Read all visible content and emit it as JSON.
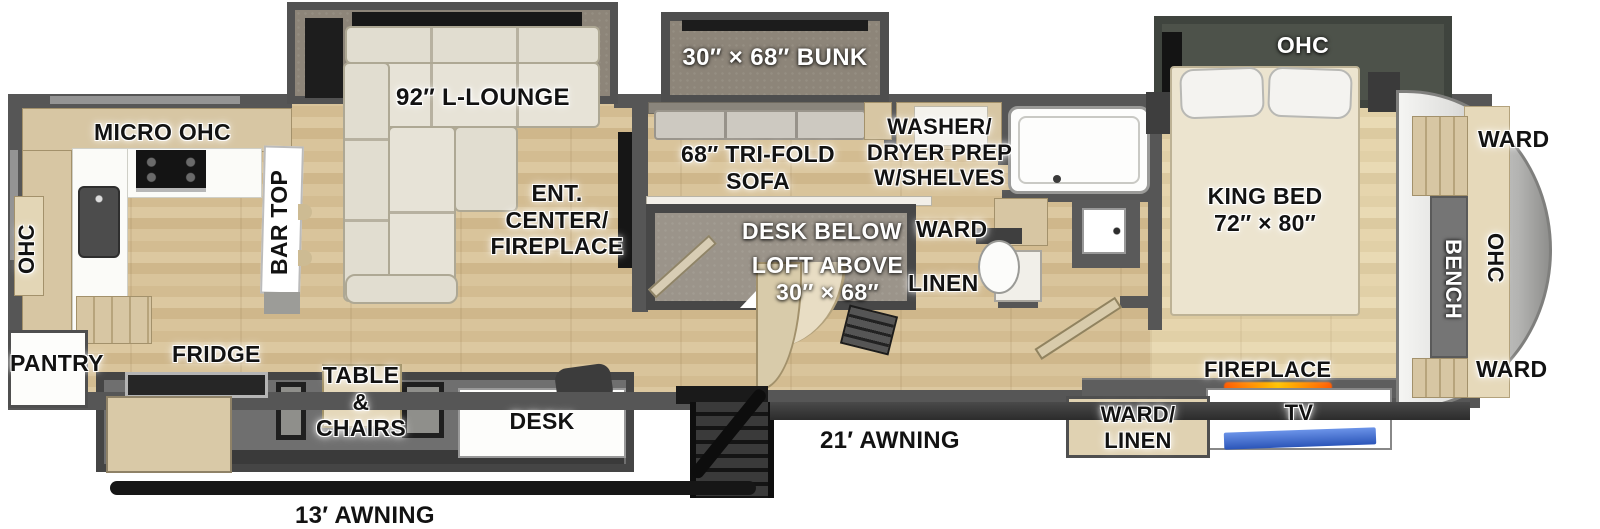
{
  "labels": {
    "kitchen": {
      "micro_ohc": "MICRO  OHC",
      "ohc_vertical": "OHC",
      "bar_top": "BAR TOP",
      "pantry": "PANTRY",
      "fridge": "FRIDGE"
    },
    "living": {
      "lounge": "92″ L-LOUNGE",
      "ent1": "ENT.",
      "ent2": "CENTER/",
      "ent3": "FIREPLACE"
    },
    "bunkroom": {
      "bunk": "30″ × 68″ BUNK",
      "trifold1": "68″ TRI-FOLD",
      "trifold2": "SOFA",
      "desk_below": "DESK BELOW",
      "loft1": "LOFT ABOVE",
      "loft2": "30″ × 68″"
    },
    "utility": {
      "washer1": "WASHER/",
      "washer2": "DRYER PREP",
      "washer3": "W/SHELVES",
      "ward": "WARD",
      "linen": "LINEN"
    },
    "dinette": {
      "table1": "TABLE",
      "table2": "&",
      "table3": "CHAIRS",
      "desk": "DESK"
    },
    "exterior": {
      "awning_13": "13′ AWNING",
      "awning_21": "21′ AWNING"
    },
    "bedroom": {
      "king1": "KING BED",
      "king2": "72″ × 80″",
      "ohc_slide": "OHC",
      "fireplace": "FIREPLACE",
      "tv": "TV",
      "wardlinen1": "WARD/",
      "wardlinen2": "LINEN"
    },
    "front_cap": {
      "ward_top": "WARD",
      "bench": "BENCH",
      "ohc": "OHC",
      "ward_bottom": "WARD"
    }
  },
  "colors": {
    "wall": "#565656",
    "floor_wood": "#d8c49c",
    "bedroom_wood": "#e4d6b2",
    "slide_interior": "#8d8579",
    "sofa_cream": "#e1ddd0",
    "cabinet_tan": "#d7c6a3",
    "fireplace_glow": "#ff7a00",
    "tv_screen": "#3a6fd8",
    "front_cap_silver": "#d9d9d7"
  }
}
